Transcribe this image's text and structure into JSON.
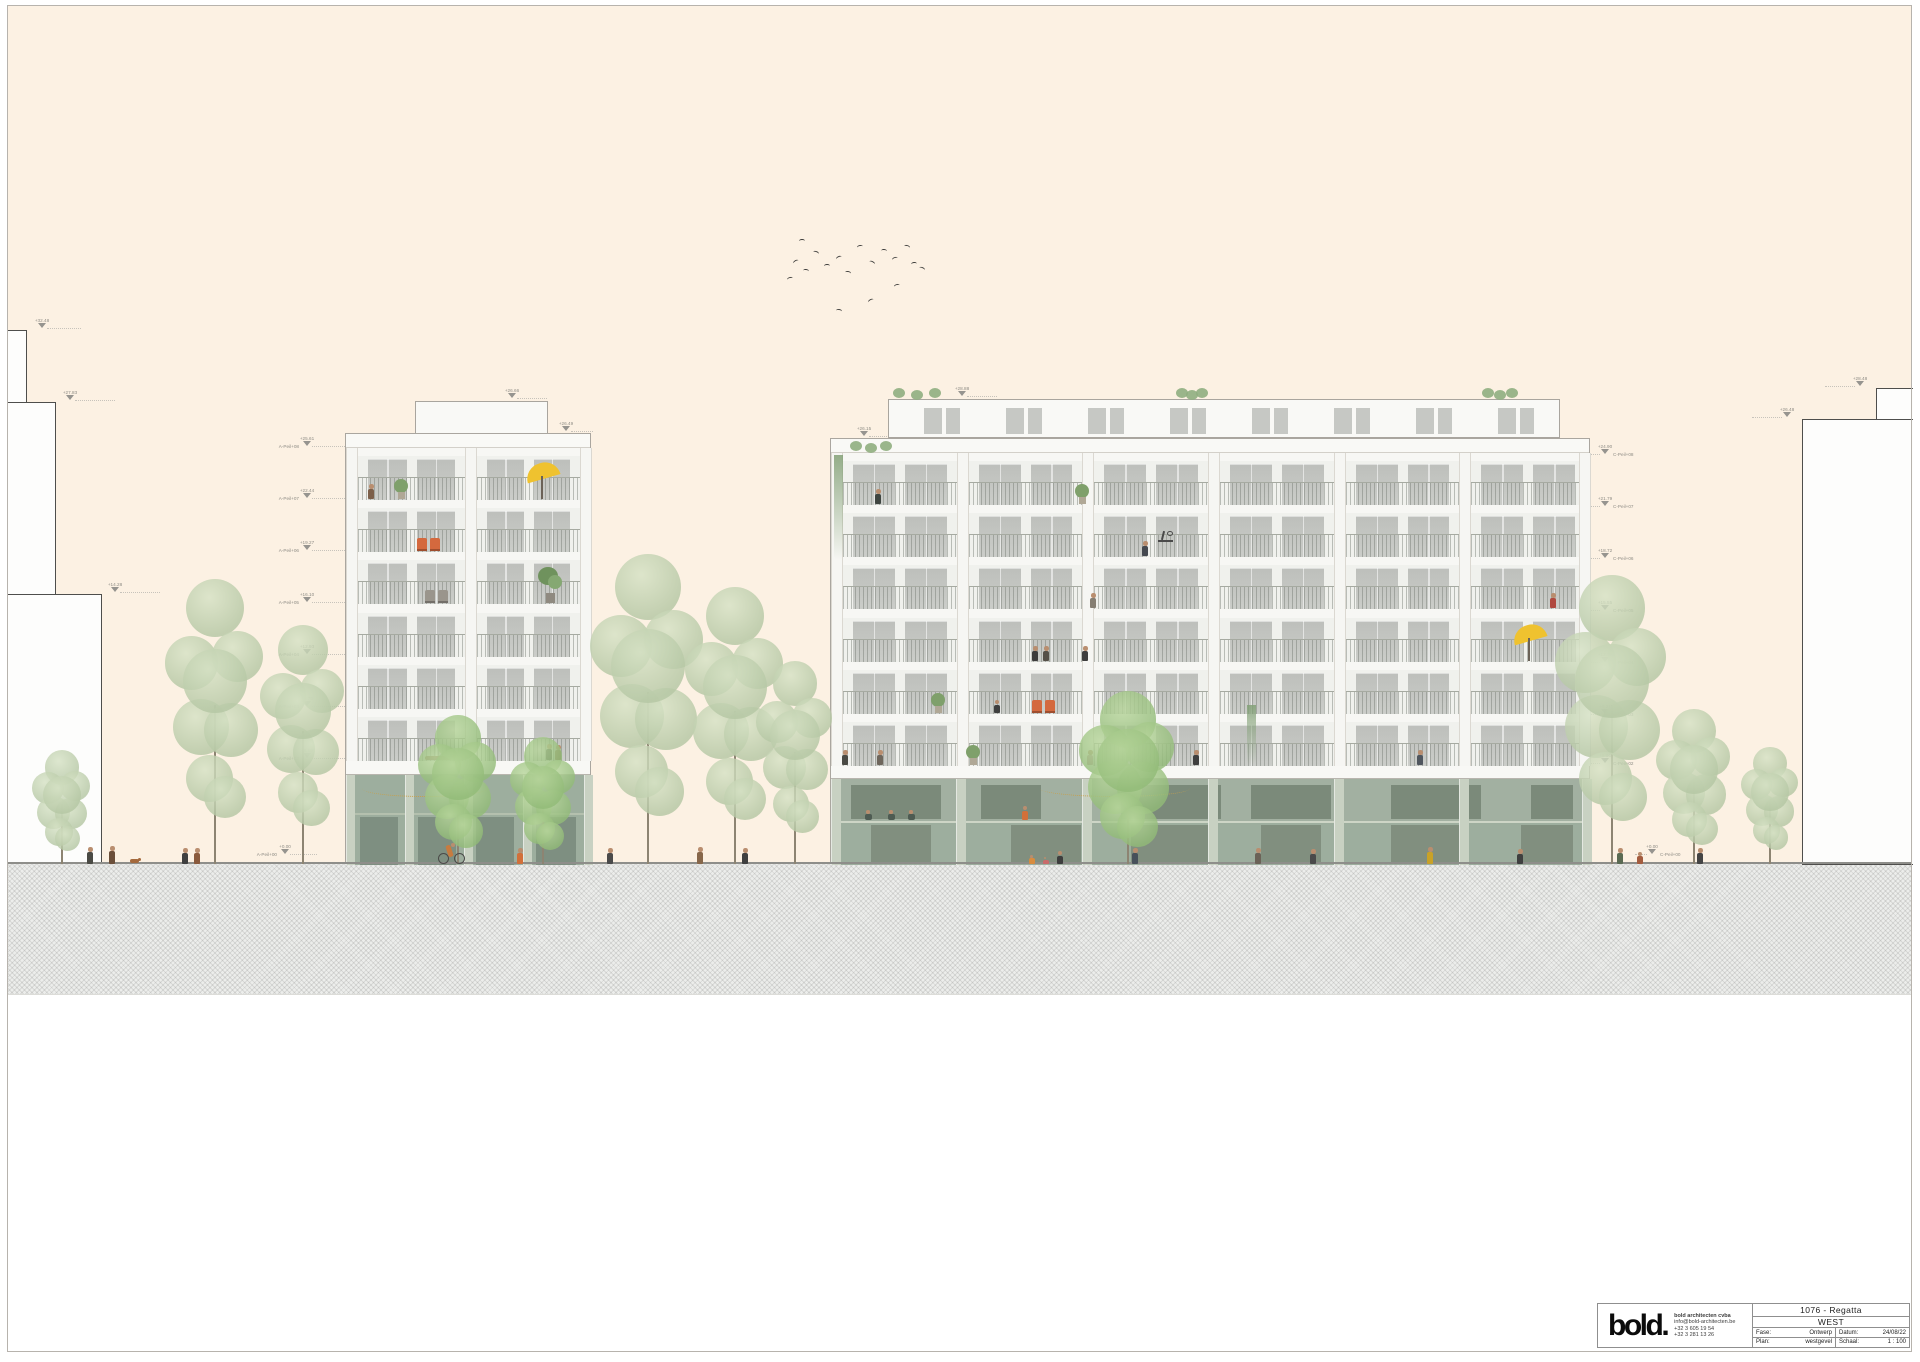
{
  "title_block": {
    "logo_text": "bold",
    "logo_dot": ".",
    "firm_name": "bold architecten cvba",
    "email": "info@bold-architecten.be",
    "phone1": "+32 3 605 19 54",
    "phone2": "+32 3 281 13 26",
    "project": "1076 -  Regatta",
    "drawing_title": "WEST",
    "fase_label": "Fase:",
    "fase_value": "Ontwerp",
    "datum_label": "Datum:",
    "datum_value": "24/08/22",
    "plan_label": "Plan:",
    "plan_value": "westgevel",
    "schaal_label": "Schaal:",
    "schaal_value": "1 : 100"
  },
  "annotations": {
    "context_left": [
      {
        "e": "+32.48",
        "x": 42,
        "y": 329,
        "d": 1,
        "len": 34
      },
      {
        "e": "+27.83",
        "x": 70,
        "y": 401,
        "d": 1,
        "len": 40
      },
      {
        "e": "+14.28",
        "x": 115,
        "y": 593,
        "d": 1,
        "len": 40
      }
    ],
    "context_right": [
      {
        "e": "+28.48",
        "x": 1860,
        "y": 387,
        "d": -1,
        "len": 30
      },
      {
        "e": "+26.48",
        "x": 1787,
        "y": 418,
        "d": -1,
        "len": 30
      }
    ],
    "top_left_building": [
      {
        "e": "+26.66",
        "x": 512,
        "y": 399,
        "d": 1,
        "len": 30
      },
      {
        "e": "+26.49",
        "x": 566,
        "y": 432,
        "d": 1,
        "len": 22
      }
    ],
    "top_right_building": [
      {
        "e": "+28.88",
        "x": 962,
        "y": 397,
        "d": 1,
        "len": 30
      },
      {
        "e": "+26.15",
        "x": 864,
        "y": 437,
        "d": 1,
        "len": 22
      }
    ],
    "levels_left": [
      {
        "e": "+25.61",
        "l": "A-Peil+08",
        "x": 307,
        "y": 447,
        "d": 1,
        "len": 33
      },
      {
        "e": "+22.44",
        "l": "A-Peil+07",
        "x": 307,
        "y": 499,
        "d": 1,
        "len": 33
      },
      {
        "e": "+19.27",
        "l": "A-Peil+06",
        "x": 307,
        "y": 551,
        "d": 1,
        "len": 33
      },
      {
        "e": "+16.10",
        "l": "A-Peil+05",
        "x": 307,
        "y": 603,
        "d": 1,
        "len": 33
      },
      {
        "e": "+12.93",
        "l": "A-Peil+04",
        "x": 307,
        "y": 655,
        "d": 1,
        "len": 33
      },
      {
        "e": "+9.76",
        "l": "A-Peil+03",
        "x": 307,
        "y": 707,
        "d": 1,
        "len": 33
      },
      {
        "e": "+6.59",
        "l": "A-Peil+02",
        "x": 307,
        "y": 759,
        "d": 1,
        "len": 33
      },
      {
        "e": "+0.00",
        "l": "A-Peil+00",
        "x": 285,
        "y": 855,
        "d": 1,
        "len": 27
      }
    ],
    "levels_right": [
      {
        "e": "+24.90",
        "l": "C-Peil+08",
        "x": 1605,
        "y": 455,
        "d": -1,
        "len": 12
      },
      {
        "e": "+21.79",
        "l": "C-Peil+07",
        "x": 1605,
        "y": 507,
        "d": -1,
        "len": 12
      },
      {
        "e": "+18.72",
        "l": "C-Peil+06",
        "x": 1605,
        "y": 559,
        "d": -1,
        "len": 12
      },
      {
        "e": "+15.55",
        "l": "C-Peil+05",
        "x": 1605,
        "y": 611,
        "d": -1,
        "len": 12
      },
      {
        "e": "+12.38",
        "l": "C-Peil+04",
        "x": 1605,
        "y": 663,
        "d": -1,
        "len": 12
      },
      {
        "e": "+9.21",
        "l": "C-Peil+03",
        "x": 1605,
        "y": 715,
        "d": -1,
        "len": 12
      },
      {
        "e": "+6.04",
        "l": "C-Peil+02",
        "x": 1605,
        "y": 764,
        "d": -1,
        "len": 12
      },
      {
        "e": "+0.00",
        "l": "C-Peil+00",
        "x": 1652,
        "y": 855,
        "d": -1,
        "len": 12
      }
    ]
  },
  "scene": {
    "colors": {
      "sky": "#fcf1e3",
      "facade": "#f7f7f4",
      "glass": "#c7c9c5",
      "ground_glass": "#9dae9e",
      "ground_glass_dark": "#7e8f81",
      "ground_col": "#c8d1c2",
      "tree": "#b5c7a4",
      "tree_light": "#d6e2c5",
      "tree_vivid": "#92bb78",
      "tree_vivid_light": "#b8d69c",
      "trunk": "#8d8472",
      "accent_orange": "#d4693e",
      "accent_yellow": "#efc22f",
      "marker": "#96948f"
    },
    "context_left_steps": [
      [
        8,
        330,
        19
      ],
      [
        8,
        402,
        48
      ],
      [
        8,
        594,
        94
      ]
    ],
    "context_right_blocks": [
      {
        "x": 1876,
        "y": 388,
        "w": 37,
        "h": 32
      },
      {
        "x": 1802,
        "y": 419,
        "w": 111,
        "h": 446
      }
    ],
    "left_building": {
      "x": 345,
      "w": 246,
      "facade_top": 433,
      "floors_top": 447,
      "floors_bottom": 760,
      "floors": 6,
      "cols": [
        0,
        119,
        234
      ],
      "col_w": 12,
      "bays": [
        [
          12,
          107
        ],
        [
          131,
          103
        ]
      ],
      "pent": {
        "x": 415,
        "y": 401,
        "w": 133,
        "h": 33
      },
      "ground": {
        "top": 760,
        "slab_h": 14,
        "cols": [
          0,
          59,
          118,
          177,
          238
        ],
        "col_w": 8,
        "interior": [
          [
            14,
            38
          ],
          [
            72,
            38
          ],
          [
            130,
            38
          ],
          [
            190,
            40
          ]
        ],
        "mezz_line": 812
      }
    },
    "right_building": {
      "x": 830,
      "w": 760,
      "facade_top": 438,
      "floors_top": 452,
      "floors_bottom": 765,
      "floors": 6,
      "cols": [
        0,
        125.7,
        251.3,
        377,
        502.7,
        628.3,
        748
      ],
      "col_w": 12,
      "bays": [
        [
          12,
          113.7
        ],
        [
          137.7,
          113.7
        ],
        [
          263.3,
          113.7
        ],
        [
          389,
          113.7
        ],
        [
          514.7,
          113.7
        ],
        [
          640.3,
          113.7
        ]
      ],
      "pent": {
        "x": 888,
        "y": 399,
        "w": 672,
        "h": 39,
        "windows": 8
      },
      "ground": {
        "top": 765,
        "slab_h": 13,
        "cols": [
          0,
          125,
          251,
          377,
          503,
          628,
          751
        ],
        "col_w": 9,
        "mezz_top": 778,
        "mezz_bottom": 820,
        "mezz_interior": [
          [
            20,
            90
          ],
          [
            150,
            60
          ],
          [
            290,
            100
          ],
          [
            420,
            80
          ],
          [
            560,
            90
          ],
          [
            700,
            42
          ]
        ],
        "lower_interior": [
          [
            40,
            60
          ],
          [
            180,
            70
          ],
          [
            300,
            80
          ],
          [
            430,
            60
          ],
          [
            560,
            70
          ],
          [
            690,
            52
          ]
        ]
      }
    },
    "trees": [
      {
        "x": 62,
        "h": 115,
        "w": 66
      },
      {
        "x": 215,
        "h": 305,
        "w": 112
      },
      {
        "x": 303,
        "h": 255,
        "w": 96
      },
      {
        "x": 458,
        "h": 150,
        "w": 88,
        "v": 1
      },
      {
        "x": 543,
        "h": 128,
        "w": 74,
        "v": 1
      },
      {
        "x": 648,
        "h": 330,
        "w": 128
      },
      {
        "x": 735,
        "h": 295,
        "w": 112
      },
      {
        "x": 795,
        "h": 215,
        "w": 86
      },
      {
        "x": 1128,
        "h": 172,
        "w": 108,
        "v": 1
      },
      {
        "x": 1612,
        "h": 305,
        "w": 126
      },
      {
        "x": 1694,
        "h": 158,
        "w": 84
      },
      {
        "x": 1770,
        "h": 120,
        "w": 64
      }
    ],
    "birds": [
      [
        793,
        260
      ],
      [
        803,
        269
      ],
      [
        787,
        277
      ],
      [
        813,
        251
      ],
      [
        824,
        264
      ],
      [
        836,
        256
      ],
      [
        845,
        271
      ],
      [
        857,
        245
      ],
      [
        869,
        261
      ],
      [
        881,
        249
      ],
      [
        892,
        257
      ],
      [
        904,
        245
      ],
      [
        911,
        262
      ],
      [
        868,
        299
      ],
      [
        836,
        309
      ],
      [
        894,
        284
      ],
      [
        919,
        267
      ],
      [
        799,
        239
      ]
    ],
    "balcony_items": [
      {
        "t": "person",
        "x": 371,
        "y": 499,
        "h": 15,
        "c": "#7c5f49"
      },
      {
        "t": "plant",
        "x": 391,
        "y": 499
      },
      {
        "t": "umbrella",
        "x": 525,
        "y": 499
      },
      {
        "t": "chairs",
        "x": 417,
        "y": 551,
        "c": "#d4693e"
      },
      {
        "t": "chairs",
        "x": 425,
        "y": 603,
        "c": "#9a958c"
      },
      {
        "t": "bigplant",
        "x": 538,
        "y": 603
      },
      {
        "t": "lying",
        "x": 425,
        "y": 760
      },
      {
        "t": "person",
        "x": 549,
        "y": 760,
        "h": 16,
        "c": "#4a4a44"
      },
      {
        "t": "person",
        "x": 558,
        "y": 760,
        "h": 15,
        "c": "#8a6b4f"
      },
      {
        "t": "lights",
        "x": 362,
        "y": 796,
        "w": 125
      },
      {
        "t": "vine",
        "x": 834,
        "y": 560,
        "h": 105
      },
      {
        "t": "shrub",
        "x": 850,
        "y": 452,
        "w": 40
      },
      {
        "t": "shrub",
        "x": 893,
        "y": 399,
        "w": 46
      },
      {
        "t": "shrub",
        "x": 1176,
        "y": 399,
        "w": 30
      },
      {
        "t": "shrub",
        "x": 1482,
        "y": 399,
        "w": 34
      },
      {
        "t": "person",
        "x": 878,
        "y": 504,
        "h": 15,
        "c": "#3f4540"
      },
      {
        "t": "plant",
        "x": 1072,
        "y": 504
      },
      {
        "t": "person",
        "x": 1145,
        "y": 556,
        "h": 15,
        "c": "#44484f"
      },
      {
        "t": "bike",
        "x": 1158,
        "y": 556
      },
      {
        "t": "person",
        "x": 1093,
        "y": 608,
        "h": 15,
        "c": "#857e72"
      },
      {
        "t": "person",
        "x": 1553,
        "y": 608,
        "h": 15,
        "c": "#b0493f"
      },
      {
        "t": "person",
        "x": 1035,
        "y": 661,
        "h": 15,
        "c": "#3d3d3d"
      },
      {
        "t": "person",
        "x": 1046,
        "y": 661,
        "h": 15,
        "c": "#555048"
      },
      {
        "t": "person",
        "x": 1085,
        "y": 661,
        "h": 15,
        "c": "#3d3d3d"
      },
      {
        "t": "umbrella",
        "x": 1512,
        "y": 661
      },
      {
        "t": "person",
        "x": 997,
        "y": 713,
        "h": 13,
        "c": "#3f3f3f"
      },
      {
        "t": "chairs",
        "x": 1032,
        "y": 713,
        "c": "#d4693e"
      },
      {
        "t": "plant",
        "x": 928,
        "y": 713
      },
      {
        "t": "person",
        "x": 845,
        "y": 765,
        "h": 15,
        "c": "#4a4a44"
      },
      {
        "t": "person",
        "x": 880,
        "y": 765,
        "h": 15,
        "c": "#6e665c"
      },
      {
        "t": "plant",
        "x": 963,
        "y": 765
      },
      {
        "t": "person",
        "x": 1090,
        "y": 765,
        "h": 15,
        "c": "#c79ba4"
      },
      {
        "t": "person",
        "x": 1196,
        "y": 765,
        "h": 15,
        "c": "#3f3f3f"
      },
      {
        "t": "person",
        "x": 1420,
        "y": 765,
        "h": 15,
        "c": "#50565e"
      },
      {
        "t": "lights",
        "x": 1040,
        "y": 796,
        "w": 150
      },
      {
        "t": "vine",
        "x": 1247,
        "y": 765,
        "h": 60
      },
      {
        "t": "sit",
        "x": 865,
        "y": 820
      },
      {
        "t": "sit",
        "x": 888,
        "y": 820
      },
      {
        "t": "sit",
        "x": 908,
        "y": 820
      },
      {
        "t": "person",
        "x": 1025,
        "y": 820,
        "h": 14,
        "c": "#d2703a"
      }
    ],
    "street_people": [
      {
        "t": "person",
        "x": 90,
        "h": 17,
        "c": "#4a4a44"
      },
      {
        "t": "person",
        "x": 112,
        "h": 18,
        "c": "#6b4f3a"
      },
      {
        "t": "dog",
        "x": 130
      },
      {
        "t": "person",
        "x": 185,
        "h": 16,
        "c": "#3f3f3f"
      },
      {
        "t": "person",
        "x": 197,
        "h": 16,
        "c": "#8a5a3c"
      },
      {
        "t": "bicycle",
        "x": 438
      },
      {
        "t": "person",
        "x": 520,
        "h": 16,
        "c": "#d2703a"
      },
      {
        "t": "person",
        "x": 610,
        "h": 16,
        "c": "#4a4a4a"
      },
      {
        "t": "person",
        "x": 700,
        "h": 17,
        "c": "#87674a"
      },
      {
        "t": "person",
        "x": 745,
        "h": 16,
        "c": "#3f3f3f"
      },
      {
        "t": "person",
        "x": 1032,
        "h": 9,
        "c": "#d88c3f"
      },
      {
        "t": "person",
        "x": 1046,
        "h": 7,
        "c": "#c96a6a"
      },
      {
        "t": "person",
        "x": 1060,
        "h": 13,
        "c": "#3d3d3d"
      },
      {
        "t": "person",
        "x": 1135,
        "h": 16,
        "c": "#47505a"
      },
      {
        "t": "person",
        "x": 1258,
        "h": 16,
        "c": "#6b6257"
      },
      {
        "t": "person",
        "x": 1313,
        "h": 15,
        "c": "#4a4a4a"
      },
      {
        "t": "person",
        "x": 1430,
        "h": 17,
        "c": "#c9a227"
      },
      {
        "t": "person",
        "x": 1520,
        "h": 15,
        "c": "#3f3f3f"
      },
      {
        "t": "person",
        "x": 1620,
        "h": 16,
        "c": "#5a6a52"
      },
      {
        "t": "person",
        "x": 1640,
        "h": 12,
        "c": "#a45c3e"
      },
      {
        "t": "person",
        "x": 1700,
        "h": 16,
        "c": "#444444"
      }
    ]
  }
}
